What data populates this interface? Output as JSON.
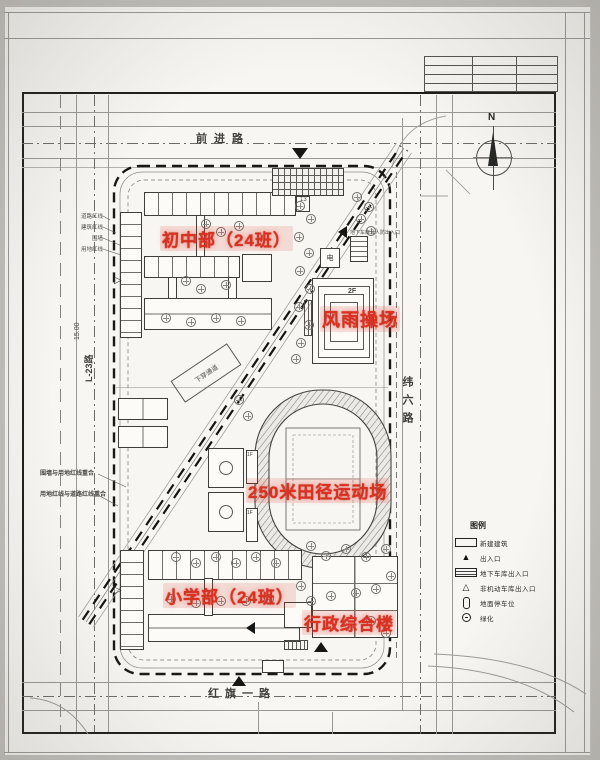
{
  "labels": {
    "middle_school": "初中部（24班）",
    "gym": "风雨操场",
    "track": "250米田径运动场",
    "primary_school": "小学部（24班）",
    "admin": "行政综合楼"
  },
  "roads": {
    "north": "前进路",
    "south": "红旗一路",
    "east": "纬六路",
    "west": "L-23路"
  },
  "legend": {
    "title": "图例",
    "items": [
      {
        "symbol": "rect",
        "label": "新建建筑"
      },
      {
        "symbol": "triangle-filled",
        "label": "出入口"
      },
      {
        "symbol": "rect-lines",
        "label": "地下车库出入口"
      },
      {
        "symbol": "triangle-open",
        "label": "非机动车库出入口"
      },
      {
        "symbol": "slot",
        "label": "地面停车位"
      },
      {
        "symbol": "circle",
        "label": "绿化"
      }
    ]
  },
  "annotations": {
    "underpass": "下穿通道",
    "dim_west": "15.00",
    "boundary_notes": [
      "道路红线",
      "建筑红线",
      "围墙",
      "用地红线"
    ],
    "left_notes": [
      "围墙与用地红线重合",
      "用地红线与道路红线重合"
    ],
    "garage_entry": "地下车库及人防出入口",
    "electric": "电",
    "gym_floor": "2F",
    "stand_floor_1": "1F",
    "stand_floor_2": "1F",
    "parking_count": "13"
  },
  "compass": {
    "letter": "N"
  },
  "colors": {
    "marker_red": "#d93222",
    "line_gray": "#4a4946",
    "sheet": "#f7f6f2"
  },
  "trees": [
    [
      300,
      206
    ],
    [
      311,
      219
    ],
    [
      299,
      237
    ],
    [
      309,
      253
    ],
    [
      300,
      271
    ],
    [
      310,
      289
    ],
    [
      299,
      307
    ],
    [
      309,
      325
    ],
    [
      301,
      343
    ],
    [
      296,
      359
    ],
    [
      357,
      197
    ],
    [
      369,
      207
    ],
    [
      361,
      219
    ],
    [
      371,
      231
    ],
    [
      206,
      224
    ],
    [
      221,
      232
    ],
    [
      239,
      226
    ],
    [
      186,
      281
    ],
    [
      201,
      289
    ],
    [
      226,
      285
    ],
    [
      166,
      318
    ],
    [
      191,
      322
    ],
    [
      216,
      318
    ],
    [
      241,
      321
    ],
    [
      311,
      546
    ],
    [
      326,
      556
    ],
    [
      346,
      549
    ],
    [
      366,
      557
    ],
    [
      386,
      549
    ],
    [
      301,
      586
    ],
    [
      311,
      601
    ],
    [
      331,
      596
    ],
    [
      356,
      593
    ],
    [
      376,
      589
    ],
    [
      391,
      576
    ],
    [
      176,
      557
    ],
    [
      196,
      563
    ],
    [
      216,
      557
    ],
    [
      236,
      563
    ],
    [
      256,
      557
    ],
    [
      276,
      563
    ],
    [
      171,
      599
    ],
    [
      196,
      603
    ],
    [
      221,
      601
    ],
    [
      246,
      601
    ],
    [
      269,
      599
    ],
    [
      371,
      621
    ],
    [
      386,
      633
    ],
    [
      248,
      416
    ],
    [
      239,
      400
    ]
  ]
}
